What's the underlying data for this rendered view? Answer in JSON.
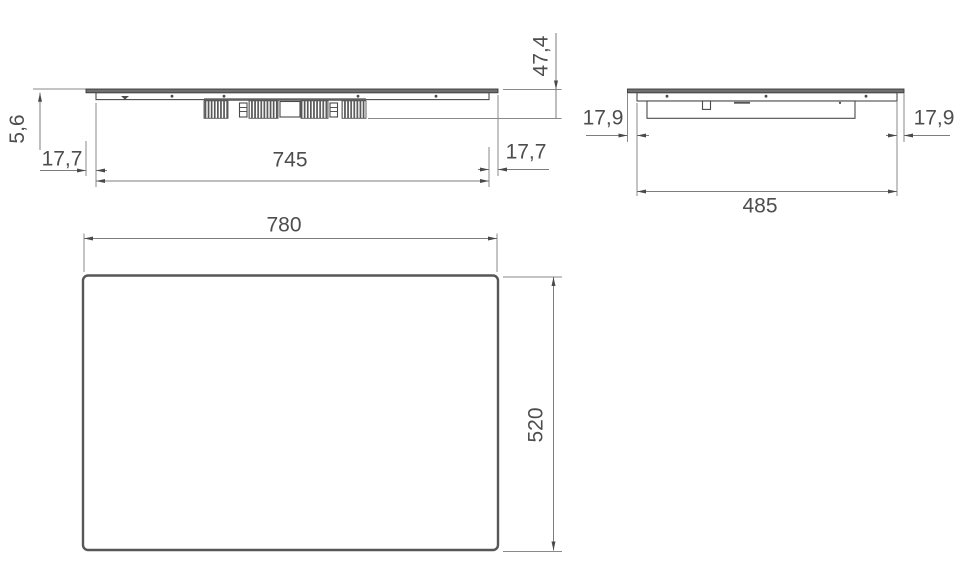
{
  "drawing": {
    "front_view": {
      "glass_thickness": "5,6",
      "total_height": "47,4",
      "overhang_left": "17,7",
      "overhang_right": "17,7",
      "body_width": "745"
    },
    "side_view": {
      "overhang_left": "17,9",
      "overhang_right": "17,9",
      "body_depth": "485"
    },
    "top_view": {
      "width": "780",
      "depth": "520"
    },
    "colors": {
      "background": "#ffffff",
      "outline": "#4a4a4a",
      "dimension_line": "#7d7d7d",
      "dimension_text": "#4d4d4d",
      "glass_fill": "#6f6f6f",
      "fin_fill": "#585858"
    }
  }
}
